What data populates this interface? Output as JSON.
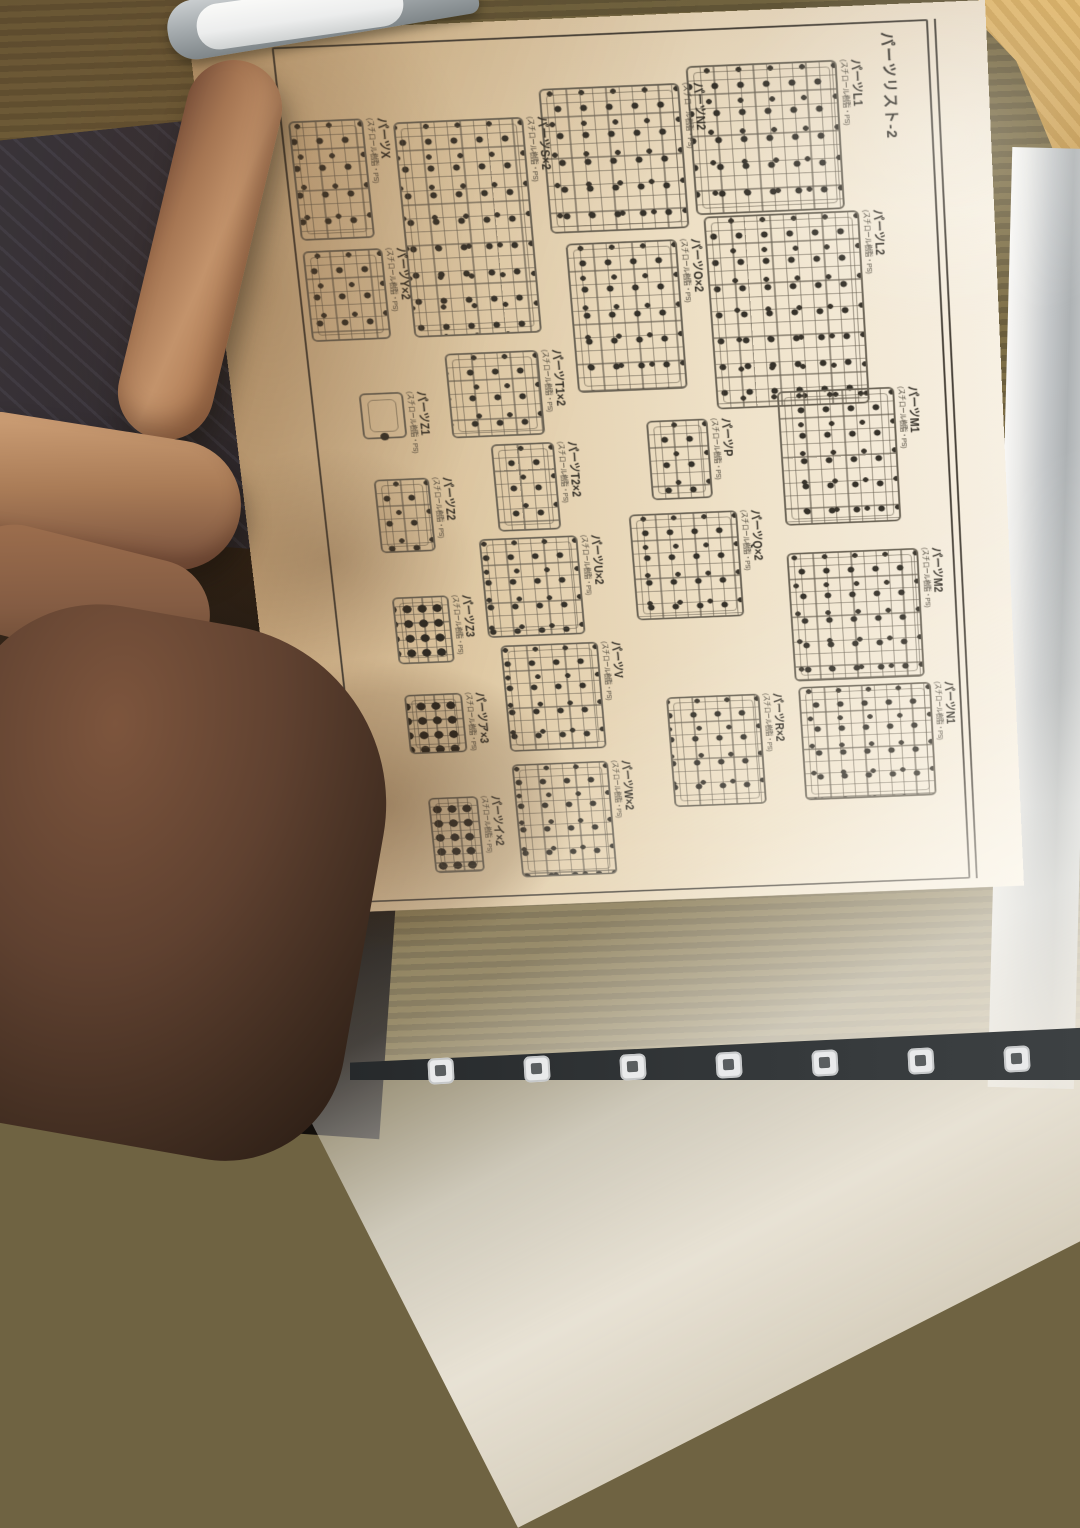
{
  "page": {
    "title": "パーツリスト-2",
    "material_note": "(スチロール樹脂・PS)",
    "page_number": "008",
    "parts": [
      "パーツL1",
      "パーツL2",
      "パーツM1",
      "パーツM2",
      "パーツN1",
      "パーツN2",
      "パーツO×2",
      "パーツP",
      "パーツQ×2",
      "パーツR×2",
      "パーツS×2",
      "パーツT1×2",
      "パーツT2×2",
      "パーツU×2",
      "パーツV",
      "パーツW×2",
      "パーツX",
      "パーツY×2",
      "パーツZ1",
      "パーツZ2",
      "パーツZ3",
      "パーツア×3",
      "パーツイ×2"
    ]
  },
  "icons": {
    "cover_tile_icon": "rounded-square-tile-icon"
  },
  "colors": {
    "paper_warm": "#e8d9bc",
    "print_ink": "#3a352c",
    "tatami_gold": "#c99a4e",
    "tatami_olive": "#7a6b44",
    "fabric_navy": "#2b2f3d",
    "skin": "#b4845f",
    "cover_gray": "#9aa0a3",
    "cover_dark": "#2e3133"
  }
}
